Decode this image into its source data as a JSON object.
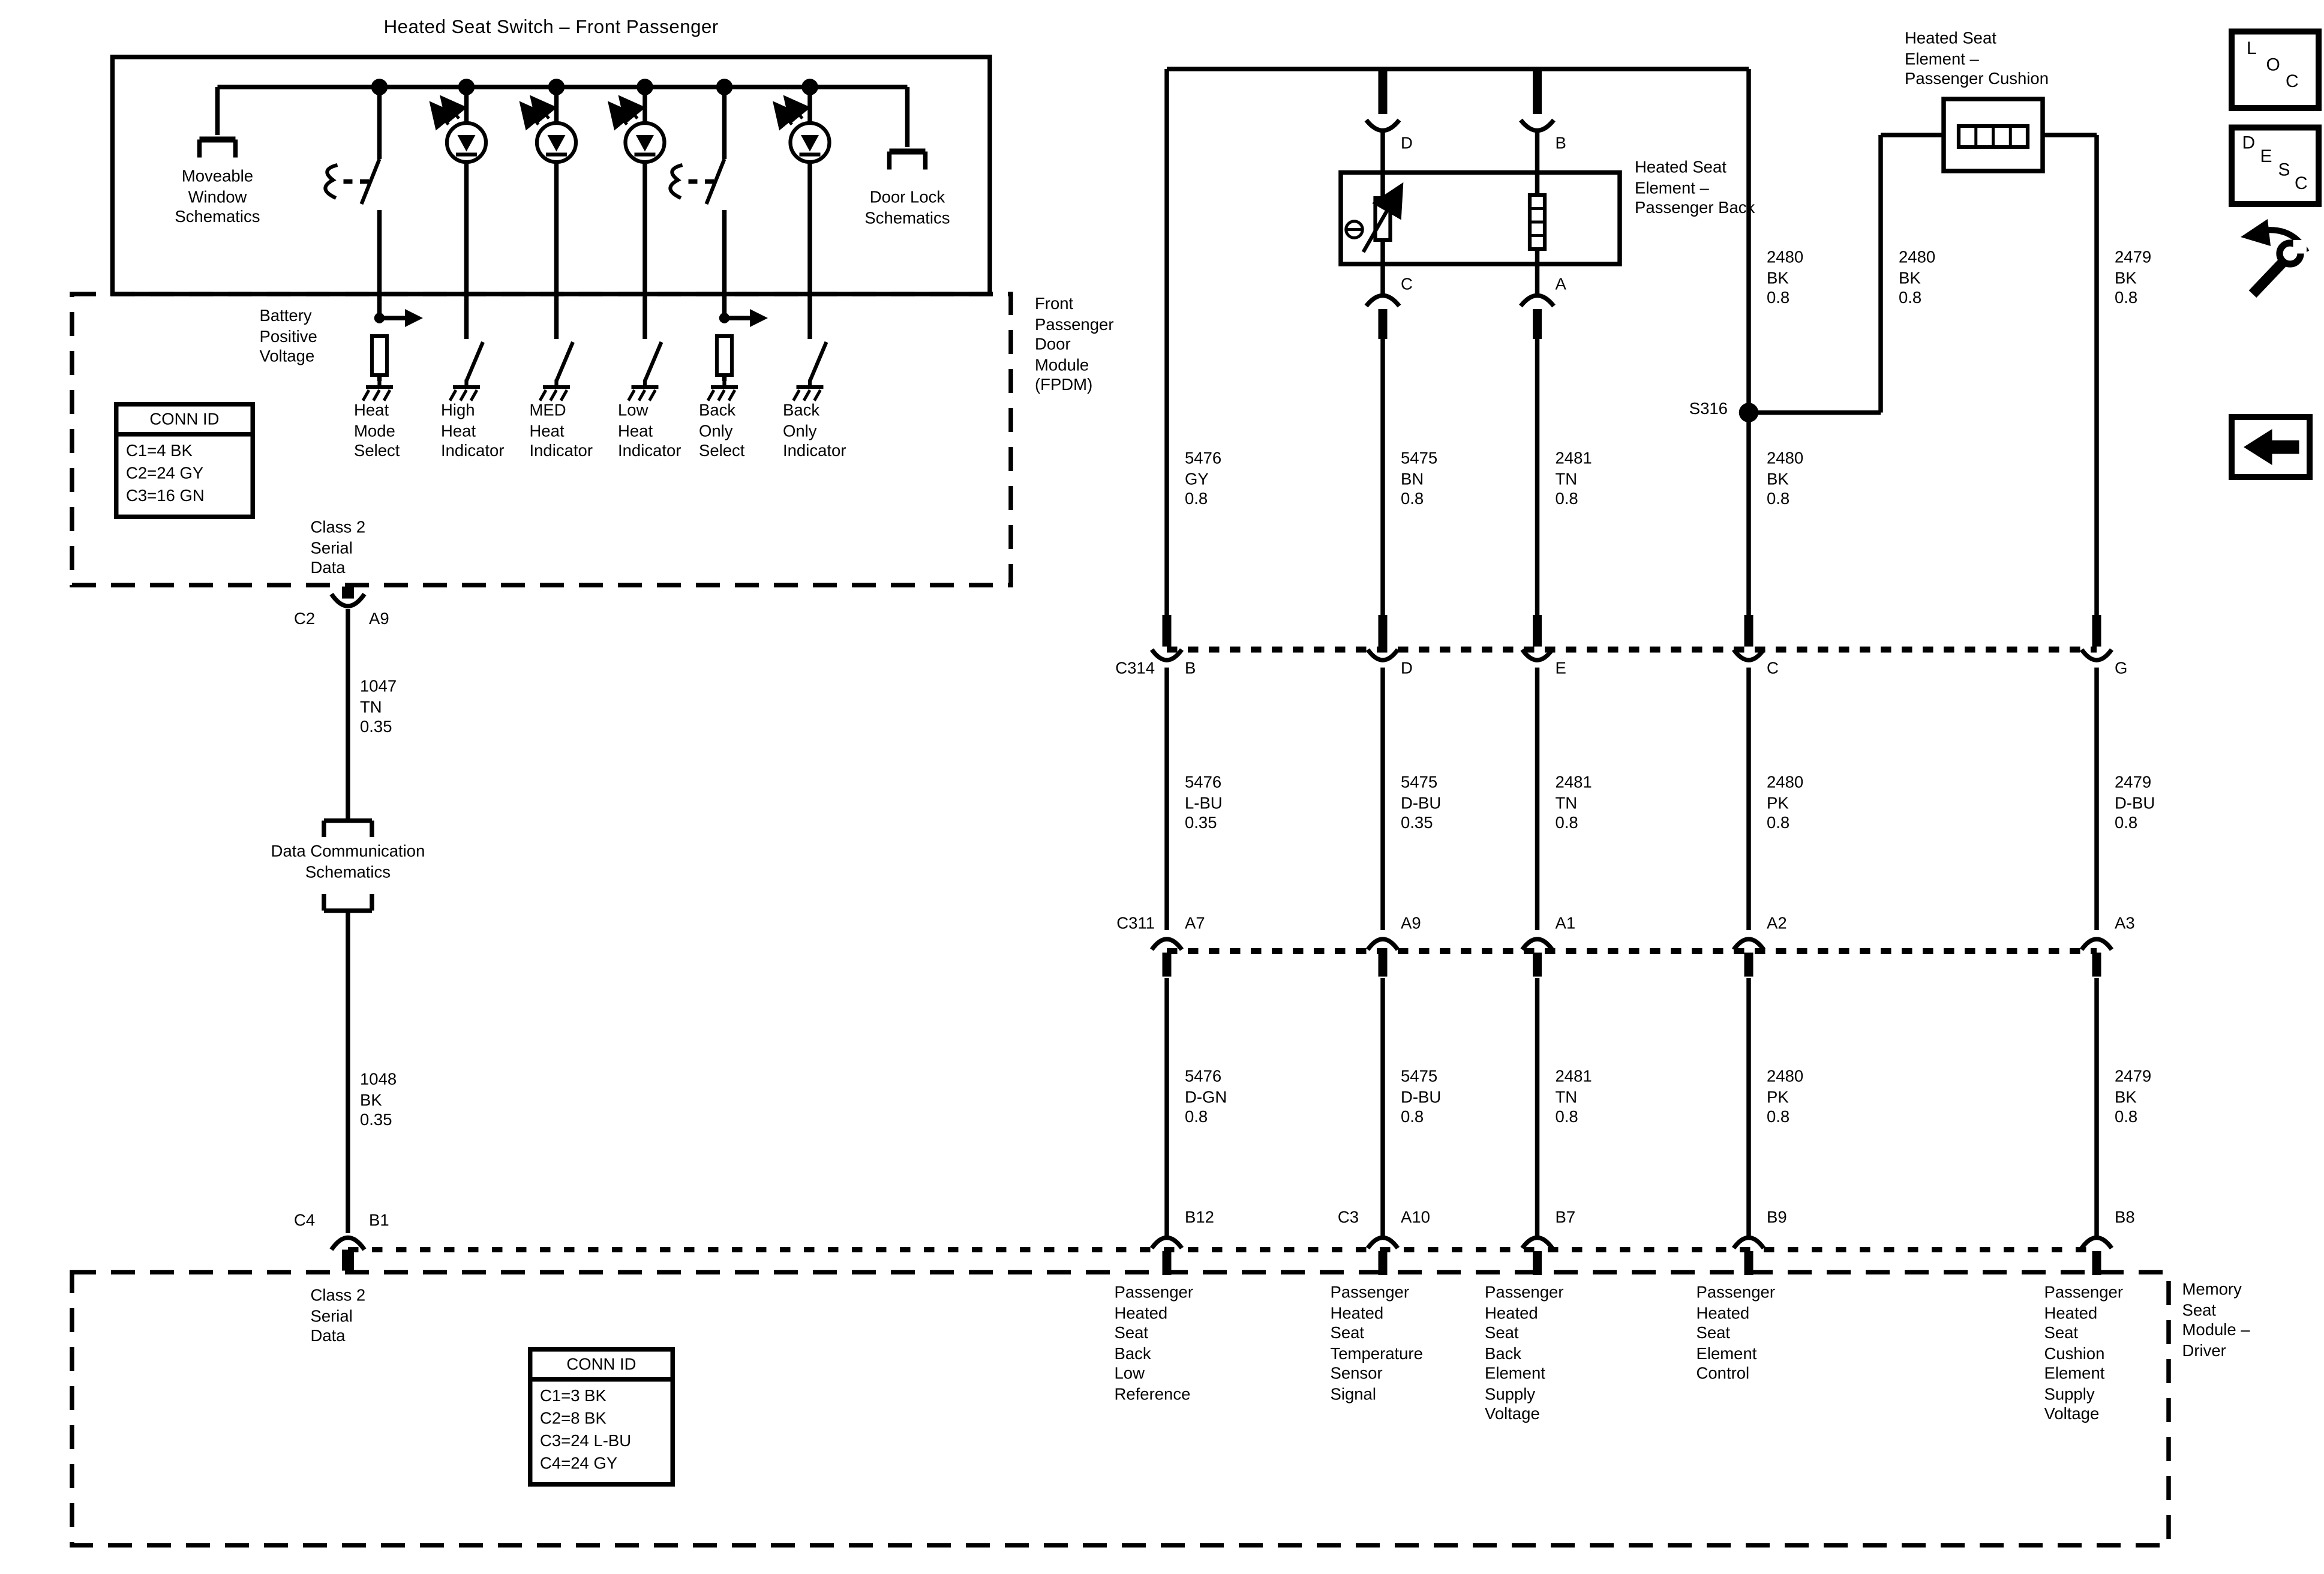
{
  "title": "Heated Seat Switch – Front Passenger",
  "switch_box": {
    "moveable_window": "Moveable\nWindow\nSchematics",
    "door_lock": "Door Lock\nSchematics"
  },
  "fpdm": {
    "battery": "Battery\nPositive\nVoltage",
    "module_label": "Front\nPassenger\nDoor\nModule\n(FPDM)",
    "columns": [
      "Heat\nMode\nSelect",
      "High\nHeat\nIndicator",
      "MED\nHeat\nIndicator",
      "Low\nHeat\nIndicator",
      "Back\nOnly\nSelect",
      "Back\nOnly\nIndicator"
    ],
    "conn_id": {
      "header": "CONN ID",
      "rows": "C1=4 BK\nC2=24 GY\nC3=16 GN"
    },
    "class2": "Class 2\nSerial\nData"
  },
  "left_wire": {
    "c2": "C2",
    "a9": "A9",
    "label_1047": "1047\nTN\n0.35",
    "data_comm": "Data Communication\nSchematics",
    "label_1048": "1048\nBK\n0.35",
    "c4": "C4",
    "b1": "B1"
  },
  "elements": {
    "back_label": "Heated Seat\nElement –\nPassenger Back",
    "cushion_label": "Heated Seat\nElement –\nPassenger Cushion",
    "pin_d": "D",
    "pin_b": "B",
    "pin_c": "C",
    "pin_a": "A"
  },
  "splice": "S316",
  "connectors": {
    "c314": {
      "name": "C314",
      "pins": [
        "B",
        "D",
        "E",
        "C",
        "G"
      ]
    },
    "c311": {
      "name": "C311",
      "pins": [
        "A7",
        "A9",
        "A1",
        "A2",
        "A3"
      ]
    },
    "c3": "C3"
  },
  "wire_labels": {
    "top": [
      "2480\nBK\n0.8",
      "2480\nBK\n0.8",
      "2479\nBK\n0.8"
    ],
    "row_a": [
      "5476\nGY\n0.8",
      "5475\nBN\n0.8",
      "2481\nTN\n0.8",
      "2480\nBK\n0.8"
    ],
    "row_b": [
      "5476\nL-BU\n0.35",
      "5475\nD-BU\n0.35",
      "2481\nTN\n0.8",
      "2480\nPK\n0.8",
      "2479\nD-BU\n0.8"
    ],
    "row_c": [
      "5476\nD-GN\n0.8",
      "5475\nD-BU\n0.8",
      "2481\nTN\n0.8",
      "2480\nPK\n0.8",
      "2479\nBK\n0.8"
    ]
  },
  "memory_module": {
    "class2": "Class 2\nSerial\nData",
    "conn_id": {
      "header": "CONN ID",
      "rows": "C1=3 BK\nC2=8 BK\nC3=24 L-BU\nC4=24 GY"
    },
    "module_label": "Memory\nSeat\nModule –\nDriver",
    "pins": [
      "B12",
      "A10",
      "B7",
      "B9",
      "B8"
    ],
    "pin_labels": [
      "Passenger\nHeated\nSeat\nBack\nLow\nReference",
      "Passenger\nHeated\nSeat\nTemperature\nSensor\nSignal",
      "Passenger\nHeated\nSeat\nBack\nElement\nSupply\nVoltage",
      "Passenger\nHeated\nSeat\nElement\nControl",
      "Passenger\nHeated\nSeat\nCushion\nElement\nSupply\nVoltage"
    ]
  },
  "nav": {
    "loc": [
      "L",
      "O",
      "C"
    ],
    "desc": [
      "D",
      "E",
      "S",
      "C"
    ]
  }
}
